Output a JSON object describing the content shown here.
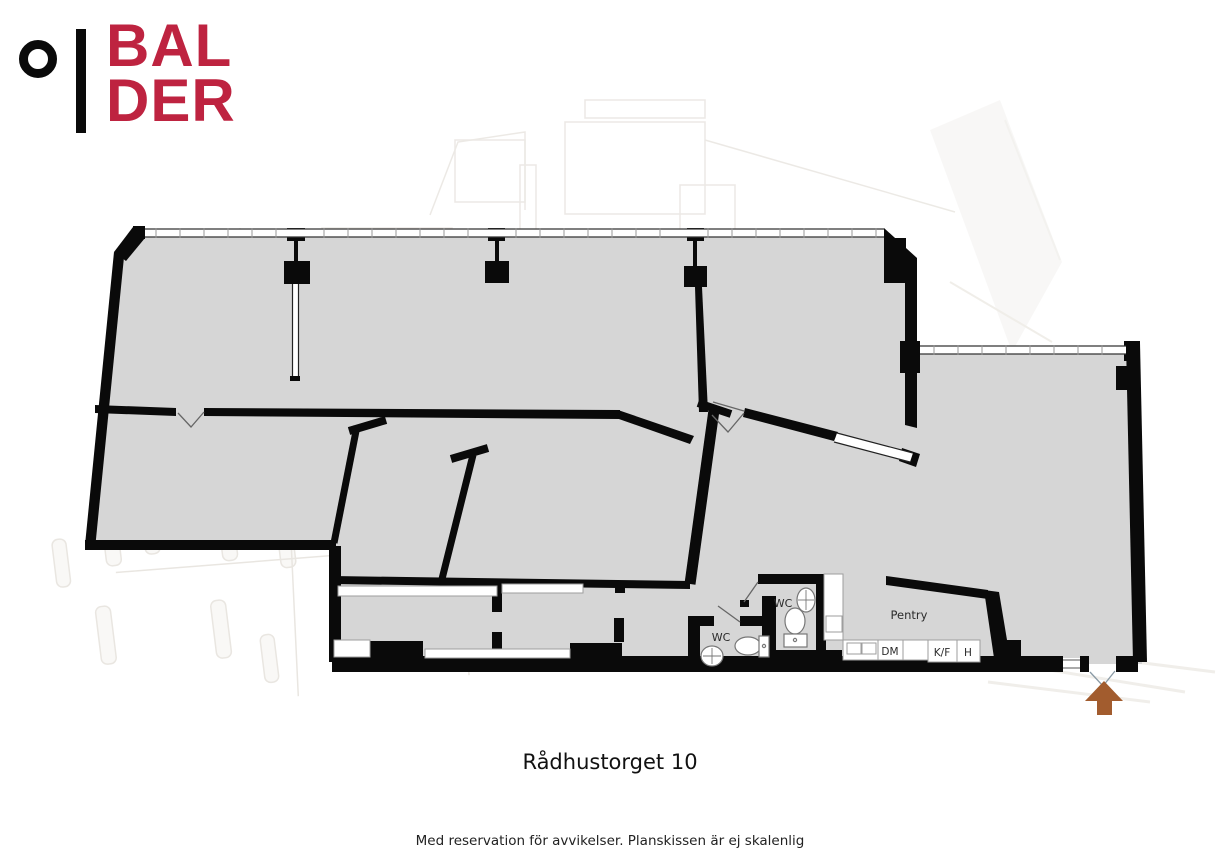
{
  "logo": {
    "line1": "BAL",
    "line2": "DER",
    "brand_color": "#BE2340"
  },
  "plan": {
    "labels": {
      "wc_upper": "WC",
      "wc_lower": "WC",
      "pentry": "Pentry",
      "dm": "DM",
      "kf": "K/F",
      "h": "H"
    },
    "colors": {
      "floor": "#D6D6D6",
      "wall": "#0a0a0a",
      "entrance_arrow": "#A25C2E"
    }
  },
  "footer": {
    "title": "Rådhustorget 10",
    "disclaimer": "Med reservation för avvikelser. Planskissen är ej skalenlig"
  }
}
